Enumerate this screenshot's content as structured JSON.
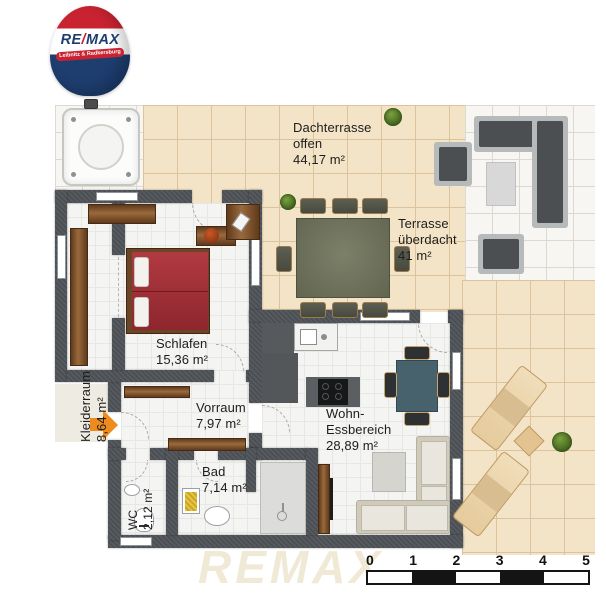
{
  "logo": {
    "brand_re": "RE",
    "brand_slash": "/",
    "brand_max": "MAX",
    "banner": "Leibnitz & Radkersburg"
  },
  "rooms": {
    "dachterrasse": {
      "name": "Dachterrasse",
      "qualifier": "offen",
      "area": "44,17 m²"
    },
    "terrasse": {
      "name": "Terrasse",
      "qualifier": "überdacht",
      "area": "41 m²"
    },
    "schlafen": {
      "name": "Schlafen",
      "area": "15,36 m²"
    },
    "kleiderraum": {
      "name": "Kleiderraum",
      "area": "8,64 m²"
    },
    "vorraum": {
      "name": "Vorraum",
      "area": "7,97 m²"
    },
    "wohn_essbereich": {
      "name": "Wohn-",
      "name2": "Essbereich",
      "area": "28,89 m²"
    },
    "wc": {
      "name": "WC",
      "area": "2,12 m²"
    },
    "bad": {
      "name": "Bad",
      "area": "7,14 m²"
    }
  },
  "scale_bar": {
    "labels": [
      "0",
      "1",
      "2",
      "3",
      "4",
      "5"
    ]
  },
  "watermark": "REMAX",
  "icons": {
    "plant": "green-shrub",
    "entrance_arrow": "orange-arrow-right",
    "logo": "remax-hot-air-balloon"
  },
  "colors": {
    "wall": "#4a4f53",
    "terrace_tile": "#f4e4c7",
    "bed": "#a8343c",
    "entrance_arrow": "#ef8b1d",
    "logo_red": "#c92331",
    "logo_blue": "#1e3e70"
  }
}
